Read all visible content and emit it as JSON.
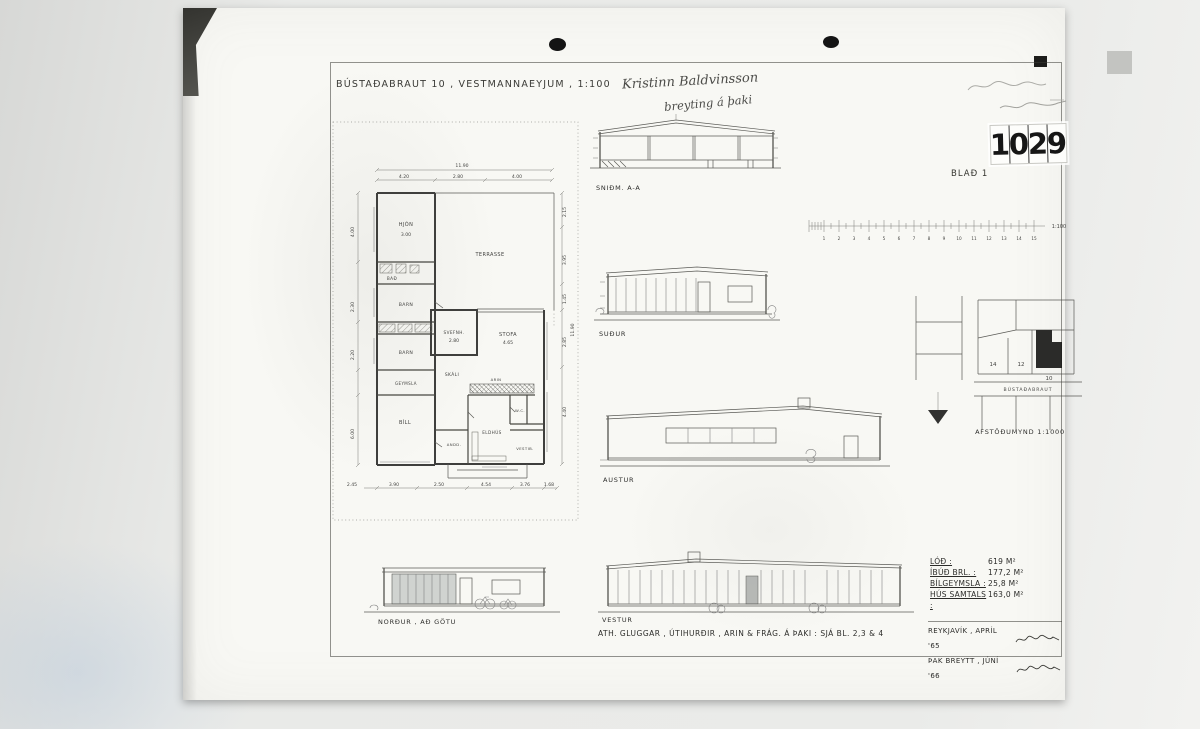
{
  "doc": {
    "title": "BÚSTAÐABRAUT 10 , VESTMANNAEYJUM , 1:100",
    "sheet": "BLAÐ 1",
    "stamp_digits": [
      "1",
      "0",
      "2",
      "9"
    ],
    "handwriting": {
      "line1": "Kristinn Baldvinsson",
      "line2": "breyting á þaki"
    },
    "note": "ATH. GLUGGAR , ÚTIHURÐIR , ARIN & FRÁG. Á ÞAKI :  SJÁ BL. 2,3 & 4",
    "sign": {
      "line1": "REYKJAVÍK , APRÍL '65",
      "line2": "ÞAK BREYTT , JÚNÍ '66"
    }
  },
  "areas": {
    "rows": [
      {
        "label": "LÓÐ :",
        "value": "619 M²"
      },
      {
        "label": "ÍBÚÐ BRL. :",
        "value": "177,2 M²"
      },
      {
        "label": "BÍLGEYMSLA :",
        "value": "25,8 M²"
      },
      {
        "label": "HÚS SAMTALS :",
        "value": "163,0 M²"
      }
    ]
  },
  "drawings": {
    "section": {
      "label": "SNIÐM. A-A"
    },
    "south": {
      "label": "SUÐUR"
    },
    "east": {
      "label": "AUSTUR"
    },
    "west": {
      "label": "VESTUR"
    },
    "north": {
      "label": "NORÐUR , AÐ GÖTU"
    },
    "site": {
      "label": "AFSTÖÐUMYND  1:1000",
      "street": "BÚSTAÐABRAUT",
      "lots": [
        "14",
        "12",
        "10"
      ]
    },
    "scale_bar": {
      "numbers": [
        "1",
        "2",
        "3",
        "4",
        "5",
        "6",
        "7",
        "8",
        "9",
        "10",
        "11",
        "12",
        "13",
        "14",
        "15"
      ],
      "label": "1:100"
    }
  },
  "floor_plan": {
    "rooms": {
      "hjon": "HJÓN",
      "bad": "BAÐ",
      "barn1": "BARN",
      "barn2": "BARN",
      "geymsla": "GEYMSLA",
      "bill": "BÍLL",
      "terrasse": "TERRASSE",
      "svefnh": "SVEFNH.",
      "stofa": "STOFA",
      "skali": "SKÁLI",
      "arin": "ARIN",
      "andd": "ANDD.",
      "eldhus": "ELDHÚS",
      "wc": "W.C.",
      "vestib": "VESTIB."
    },
    "dims": {
      "top_total": "11.90",
      "top1": "4.20",
      "top2": "2.80",
      "top3": "4.00",
      "bot0": "2.45",
      "bot1": "3.90",
      "bot2": "2.50",
      "bot3": "4.54",
      "bot4": "3.76",
      "bot5": "1.68",
      "left1": "4.00",
      "left2": "2.30",
      "left3": "2.20",
      "left4": "6.00",
      "right1": "2.15",
      "right2": "3.95",
      "right3": "1.45",
      "right4": "2.85",
      "right5": "4.40",
      "right_total": "11.90",
      "hjon_w": "3.00",
      "svefnh_w": "2.80",
      "stofa_w": "4.65"
    }
  }
}
